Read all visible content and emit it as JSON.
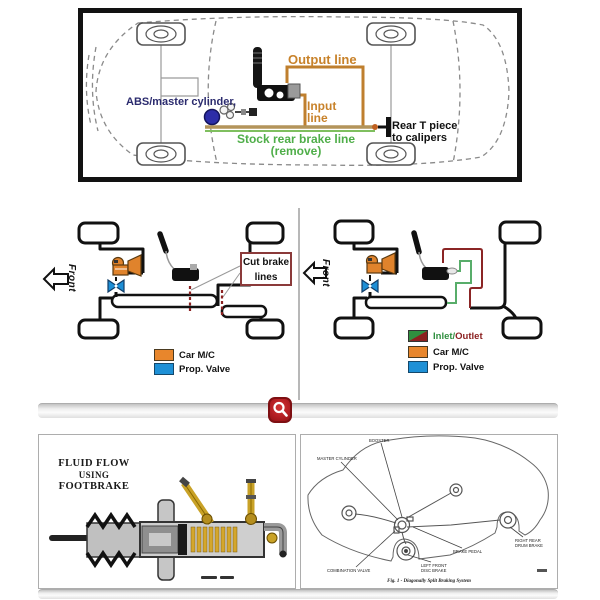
{
  "top_panel": {
    "labels": {
      "abs_master_cylinder": "ABS/master cylinder,",
      "output_line": "Output line",
      "input_line_1": "Input",
      "input_line_2": "line",
      "stock_line_1": "Stock rear brake line",
      "stock_line_2": "(remove)",
      "rear_t_1": "Rear T piece",
      "rear_t_2": "to calipers"
    },
    "colors": {
      "orange_line": "#bf7f2e",
      "green_line": "#7fbf5f",
      "blue_dot": "#2d2da8",
      "orange_text": "#c8822a",
      "green_text": "#4fae49",
      "navy_text": "#2b2b6e"
    }
  },
  "middle_left": {
    "front_label": "Front",
    "cut_box_1": "Cut brake",
    "cut_box_2": "lines",
    "legend": [
      {
        "label": "Car M/C",
        "color": "#e8862c"
      },
      {
        "label": "Prop. Valve",
        "color": "#1e90d6"
      }
    ],
    "cut_mark_color": "#8b2222"
  },
  "middle_right": {
    "front_label": "Front",
    "legend_io": {
      "part1": "Inlet/",
      "part2": "Outlet",
      "inlet_color": "#2f8f3f",
      "outlet_color": "#8b2020"
    },
    "legend": [
      {
        "label": "Car M/C",
        "color": "#e8862c"
      },
      {
        "label": "Prop. Valve",
        "color": "#1e90d6"
      }
    ]
  },
  "magnifier": {
    "color": "#b51f24"
  },
  "bottom_left": {
    "title_1": "FLUID FLOW",
    "title_2": "USING",
    "title_3": "FOOTBRAKE"
  },
  "bottom_right": {
    "labels": {
      "booster": "BOOSTER",
      "master_cylinder": "MASTER CYLINDER",
      "combination_valve": "COMBINATION VALVE",
      "brake_pedal": "BRAKE PEDAL",
      "front_disc_1": "LEFT FRONT",
      "front_disc_2": "DISC BRAKE",
      "rear_drum_1": "RIGHT REAR",
      "rear_drum_2": "DRUM BRAKE"
    },
    "caption": "Fig. 1 - Diagonally Split Braking System"
  }
}
